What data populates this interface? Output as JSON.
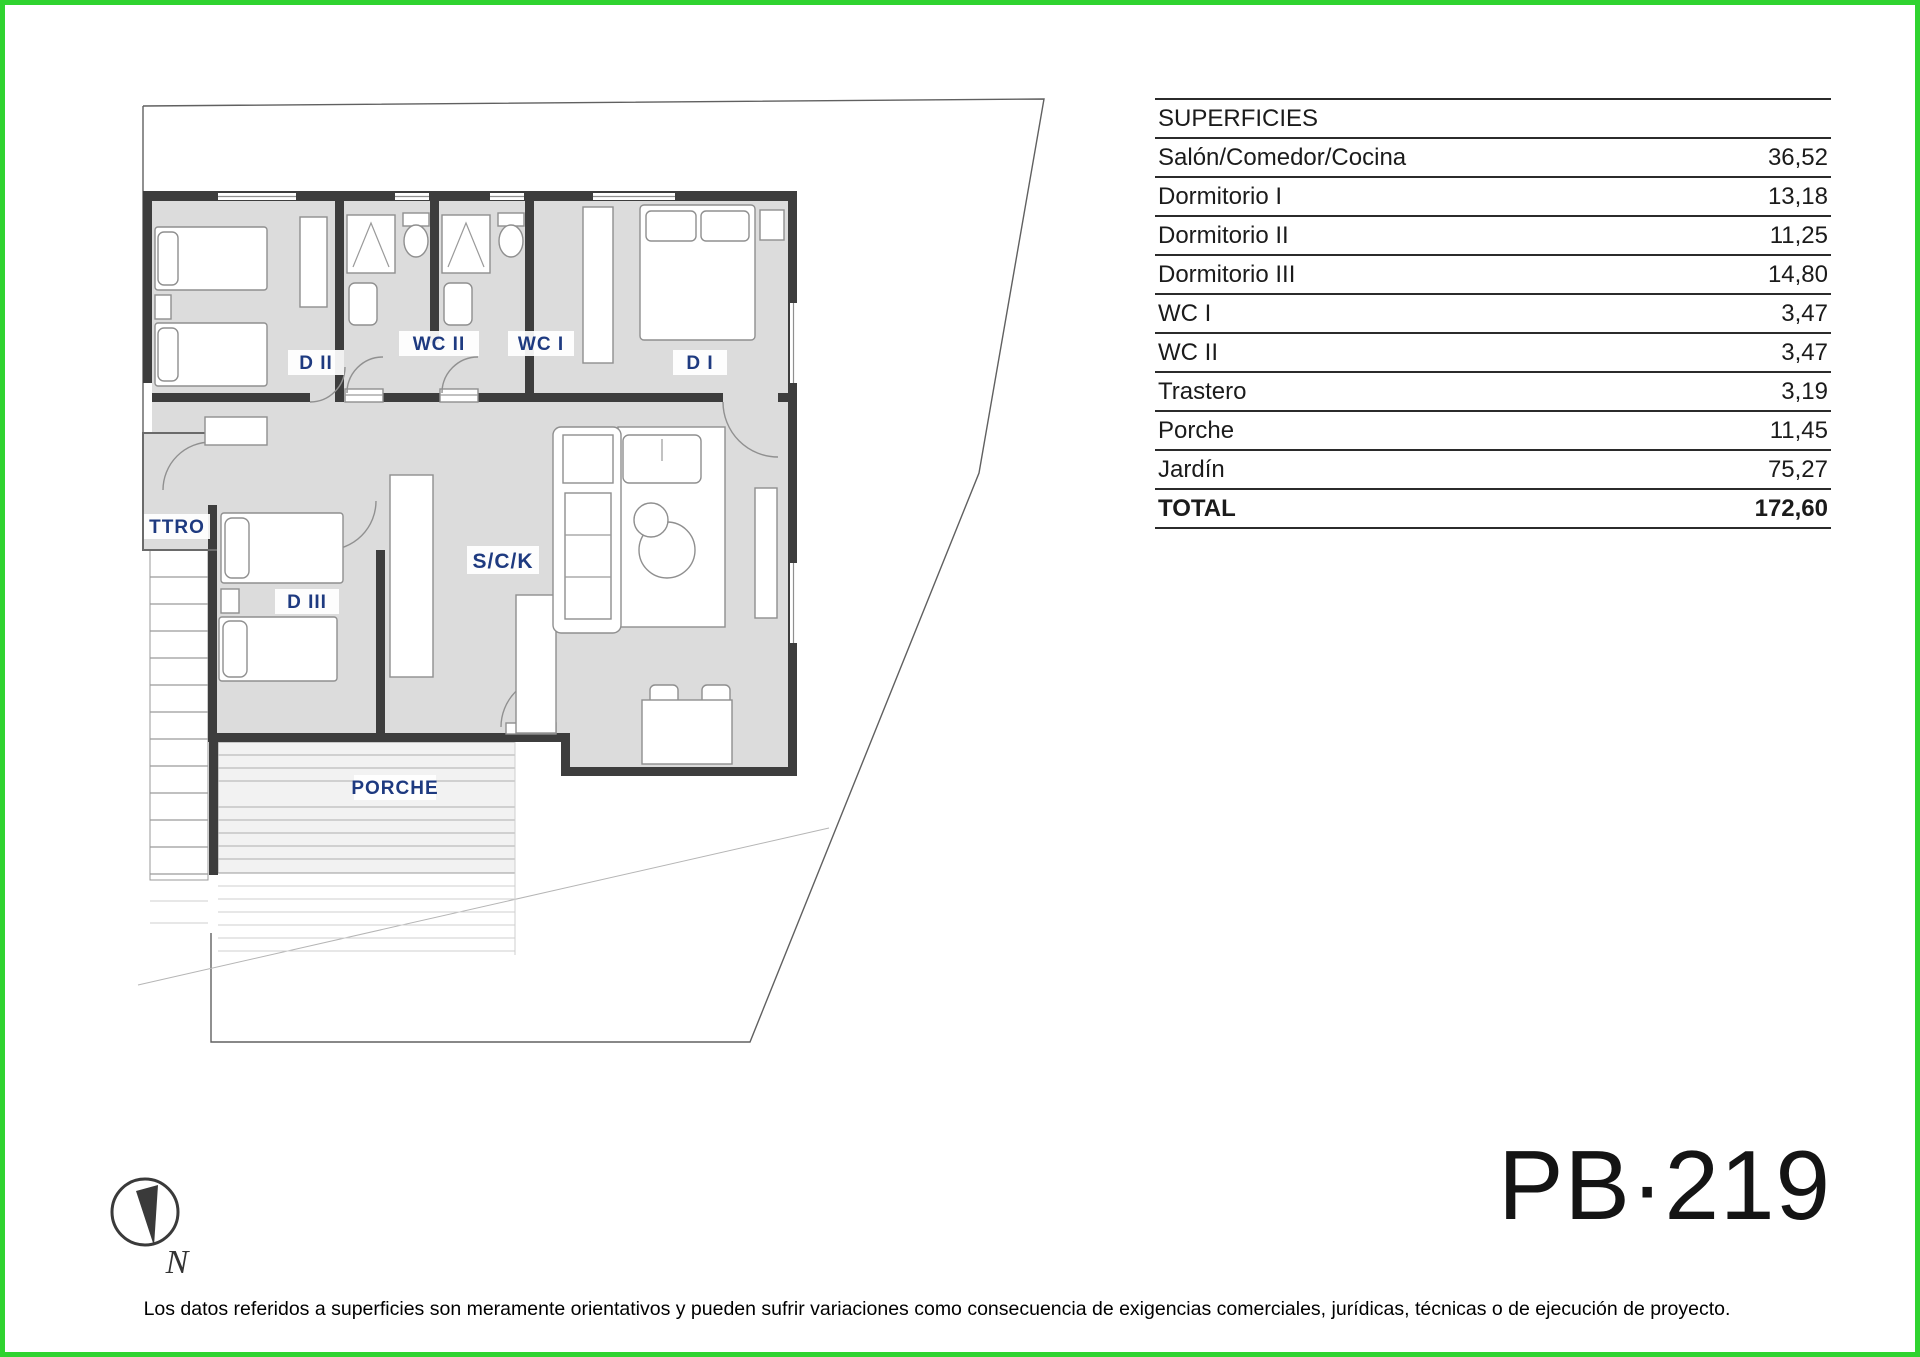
{
  "page": {
    "code": "PB·219",
    "disclaimer": "Los datos referidos a superficies son meramente orientativos y pueden sufrir variaciones como consecuencia de exigencias comerciales, jurídicas, técnicas o de ejecución de proyecto.",
    "border_color": "#2fd32f",
    "accent_label_color": "#1e3a80",
    "room_fill_color": "#dcdcdc",
    "wall_color": "#3d3d3d"
  },
  "superficies": {
    "title": "SUPERFICIES",
    "rows": [
      {
        "label": "Salón/Comedor/Cocina",
        "value": "36,52"
      },
      {
        "label": "Dormitorio I",
        "value": "13,18"
      },
      {
        "label": "Dormitorio II",
        "value": "11,25"
      },
      {
        "label": "Dormitorio III",
        "value": "14,80"
      },
      {
        "label": "WC I",
        "value": "3,47"
      },
      {
        "label": "WC II",
        "value": "3,47"
      },
      {
        "label": "Trastero",
        "value": "3,19"
      },
      {
        "label": "Porche",
        "value": "11,45"
      },
      {
        "label": "Jardín",
        "value": "75,27"
      }
    ],
    "total": {
      "label": "TOTAL",
      "value": "172,60"
    }
  },
  "plan": {
    "labels": {
      "d1": "D I",
      "d2": "D II",
      "d3": "D III",
      "wc1": "WC I",
      "wc2": "WC II",
      "ttro": "TTRO",
      "sck": "S/C/K",
      "porche": "PORCHE"
    },
    "compass": {
      "north_label": "N"
    }
  }
}
